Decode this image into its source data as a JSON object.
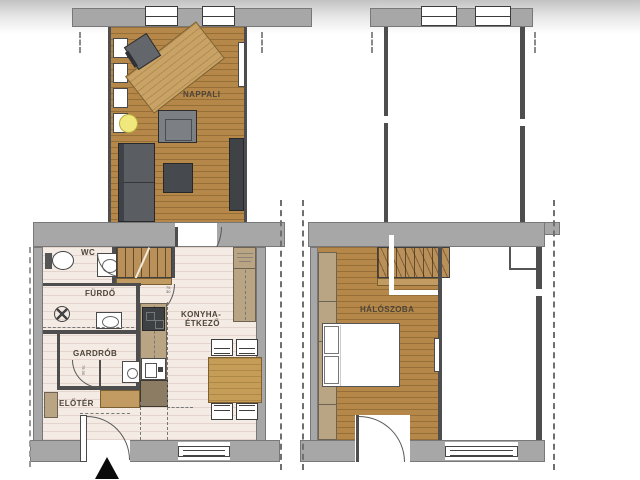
{
  "document": {
    "type": "architectural floor plan (two levels)",
    "language": "hu"
  },
  "colors": {
    "wall_gray": "#a7a7a7",
    "wall_line": "#4e4e4e",
    "wood_floor": "#b5884a",
    "wood_light": "#c9a366",
    "tile_floor": "#f4ebe5",
    "cabinet_tan": "#b9a584",
    "cabinet_dark_tan": "#8d7c64",
    "furniture_dark": "#54585c",
    "pouf_yellow": "#f0e87c",
    "label_text": "#4e4437"
  },
  "ground": {
    "labels": {
      "nappali": "NAPPALI",
      "wc": "WC",
      "furdo": "FÜRDŐ",
      "gardrob": "GARDRÓB",
      "eloter": "ELŐTÉR",
      "konyha1": "KONYHA-",
      "konyha2": "ÉTKEZŐ"
    },
    "door_tags": {
      "furdo_w": "75",
      "furdo_h": "30",
      "gardrob": "75 30"
    }
  },
  "upper": {
    "labels": {
      "haloszoba": "HÁLÓSZOBA"
    }
  }
}
